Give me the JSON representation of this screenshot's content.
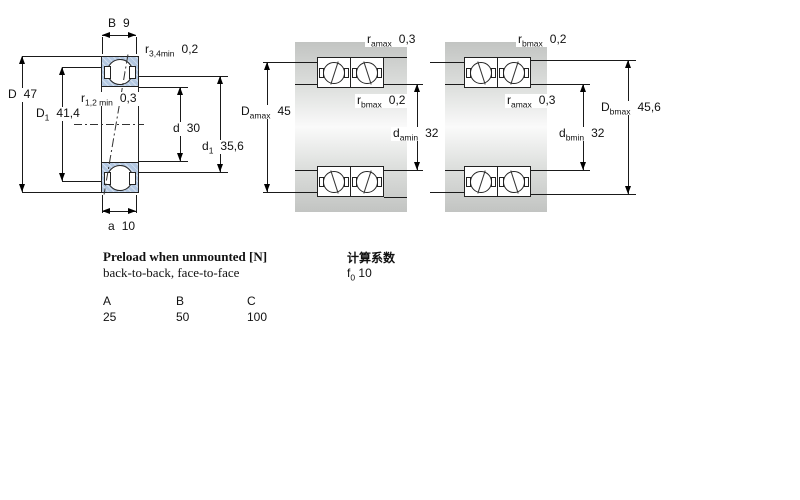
{
  "colors": {
    "bearing_blue": "#b3c8e2",
    "shaft_gray": "#c9cbc9",
    "line": "#1a1a1a"
  },
  "left": {
    "B": {
      "base": "B",
      "sub": "",
      "value": "9"
    },
    "r34": {
      "base": "r",
      "sub": "3,4min",
      "value": "0,2"
    },
    "D": {
      "base": "D",
      "sub": "",
      "value": "47"
    },
    "D1": {
      "base": "D",
      "sub": "1",
      "value": "41,4"
    },
    "r12": {
      "base": "r",
      "sub": "1,2 min",
      "value": "0,3"
    },
    "d": {
      "base": "d",
      "sub": "",
      "value": "30"
    },
    "d1": {
      "base": "d",
      "sub": "1",
      "value": "35,6"
    },
    "a": {
      "base": "a",
      "sub": "",
      "value": "10"
    }
  },
  "mid": {
    "r_amax": {
      "base": "r",
      "sub": "amax",
      "value": "0,3"
    },
    "r_bmax": {
      "base": "r",
      "sub": "bmax",
      "value": "0,2"
    },
    "D_amax": {
      "base": "D",
      "sub": "amax",
      "value": "45"
    },
    "d_amin": {
      "base": "d",
      "sub": "amin",
      "value": "32"
    }
  },
  "right": {
    "r_bmax": {
      "base": "r",
      "sub": "bmax",
      "value": "0,2"
    },
    "r_amax": {
      "base": "r",
      "sub": "amax",
      "value": "0,3"
    },
    "D_bmax": {
      "base": "D",
      "sub": "bmax",
      "value": "45,6"
    },
    "d_bmin": {
      "base": "d",
      "sub": "bmin",
      "value": "32"
    }
  },
  "preload": {
    "title": "Preload when unmounted [N]",
    "subtitle": "back-to-back, face-to-face",
    "headers": [
      "A",
      "B",
      "C"
    ],
    "values": [
      "25",
      "50",
      "100"
    ]
  },
  "calc": {
    "title": "计算系数",
    "f0": {
      "base": "f",
      "sub": "0",
      "value": "10"
    }
  }
}
